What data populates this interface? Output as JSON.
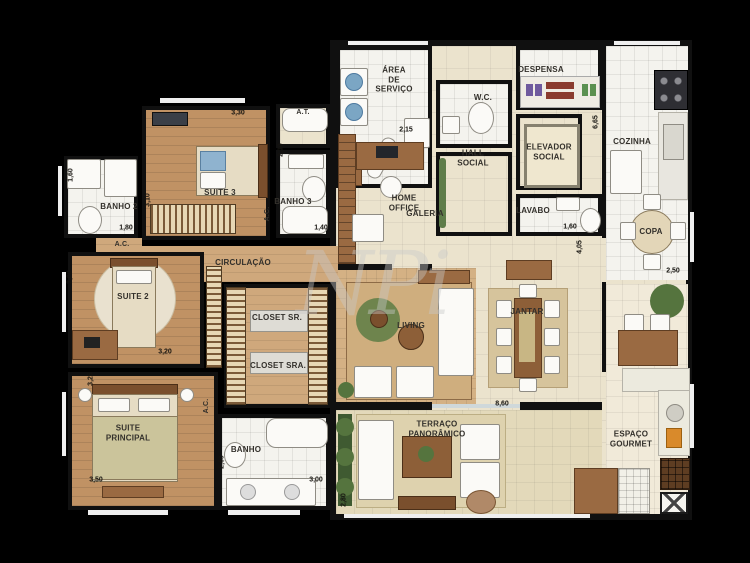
{
  "watermark": "NPi",
  "colors": {
    "background": "#000000",
    "wall": "#101010",
    "wood_floor": "#c09264",
    "light_wood_floor": "#cfa87c",
    "living_wood_floor": "#d4b184",
    "tile_floor": "#f4f3ee",
    "cream_floor": "#ebe3cd",
    "terrace_floor": "#e3d9ba",
    "accent_green": "#55743e",
    "accent_blue": "#7ba6c4",
    "furniture_brown": "#9a6a42"
  },
  "rooms": {
    "banho2": {
      "label": "BANHO 2"
    },
    "suite3": {
      "label": "SUITE 3"
    },
    "banho3": {
      "label": "BANHO 3"
    },
    "circulacao": {
      "label": "CIRCULAÇÃO"
    },
    "suite2": {
      "label": "SUITE 2"
    },
    "closet_sr": {
      "label": "CLOSET SR."
    },
    "closet_sra": {
      "label": "CLOSET SRA."
    },
    "suite_principal": {
      "label": "SUITE\nPRINCIPAL"
    },
    "banho": {
      "label": "BANHO"
    },
    "area_servico": {
      "label": "ÁREA\nDE\nSERVIÇO"
    },
    "wc": {
      "label": "W.C."
    },
    "despensa": {
      "label": "DESPENSA"
    },
    "hall_social": {
      "label": "HALL\nSOCIAL"
    },
    "elevador_social": {
      "label": "ELEVADOR\nSOCIAL"
    },
    "lavabo": {
      "label": "LAVABO"
    },
    "cozinha": {
      "label": "COZINHA"
    },
    "copa": {
      "label": "COPA"
    },
    "galeria": {
      "label": "GALERIA"
    },
    "home_office": {
      "label": "HOME\nOFFICE"
    },
    "living": {
      "label": "LIVING"
    },
    "jantar": {
      "label": "JANTAR"
    },
    "terraco": {
      "label": "TERRAÇO\nPANORÂMICO"
    },
    "espaco_gourmet": {
      "label": "ESPAÇO\nGOURMET"
    }
  },
  "marks": {
    "at": "A.T.",
    "ac1": "A.C.",
    "ac2": "A.C.",
    "ac3": "A.C."
  },
  "dims": {
    "suite3_top": "3,30",
    "suite3_left": "3,10",
    "banho2_left": "1,60",
    "banho2_bottom": "1,80",
    "banho3_top": "2,30",
    "banho3_bottom": "1,40",
    "area_servico": "2,15",
    "cozinha_left": "6,65",
    "lavabo_bottom": "1,60",
    "galeria_right": "4,05",
    "copa_bottom": "2,50",
    "suite2_left": "3,00",
    "suite2_bottom": "3,20",
    "suite_principal_left": "3,25",
    "suite_principal_bottom": "3,50",
    "banho_left": "2,60",
    "banho_bottom": "3,00",
    "terraco_top": "8,60",
    "terraco_left": "2,80"
  }
}
